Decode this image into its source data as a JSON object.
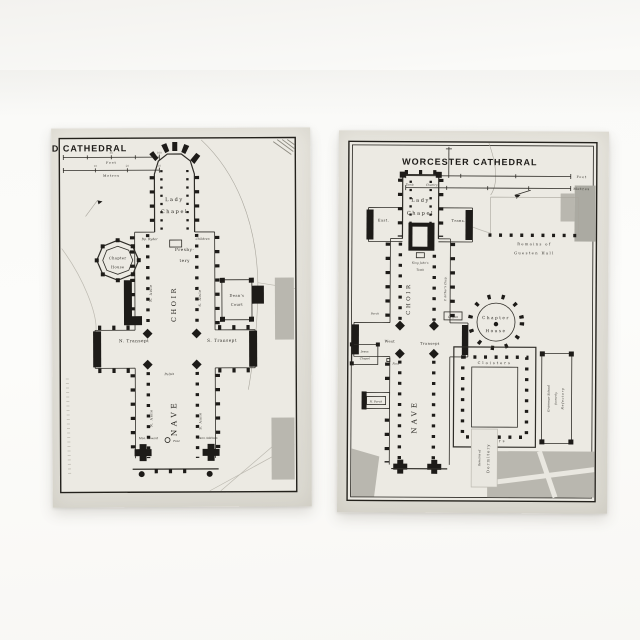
{
  "colors": {
    "background": "#fafaf8",
    "paper": "#e6e4dd",
    "ink": "#1d1b18",
    "shade": "#b9b7af"
  },
  "lichfield": {
    "title": "LICHFIELD CATHEDRAL",
    "scale": {
      "feet_label": "Feet",
      "metres_label": "Metres",
      "feet_ticks": [
        "50",
        "100"
      ],
      "metre_ticks": [
        "10",
        "20",
        "30"
      ]
    },
    "labels": {
      "lady1": "Lady",
      "lady2": "Chapel",
      "bp_ryder": "Bp. Ryder",
      "children": "Children",
      "chapter1": "Chapter",
      "chapter2": "House",
      "presbytery1": "Presby-",
      "presbytery2": "tery",
      "n_aisle_choir": "N. Aisle",
      "s_aisle_choir": "S. Aisle",
      "choir": "CHOIR",
      "deans1": "Dean's",
      "deans2": "Court",
      "n_transept": "N. Transept",
      "s_transept": "S. Transept",
      "pulpit": "Pulpit",
      "nave": "NAVE",
      "n_aisle_nave": "N. Aisle",
      "s_aisle_nave": "S. Aisle",
      "mon_seward": "Mon. Seward",
      "font": "Font",
      "dean_addison": "Dean Addison"
    }
  },
  "worcester": {
    "title": "WORCESTER CATHEDRAL",
    "scale": {
      "feet_label": "Feet",
      "metres_label": "Metres"
    },
    "labels": {
      "tomb": "Tomb",
      "chantry": "Chantry",
      "lady1": "Lady",
      "lady2": "Chapel",
      "east_l": "East.",
      "east_r": "Trans.",
      "king1": "King John's",
      "king2": "Tomb",
      "choir": "CHOIR",
      "p_arthur": "P. Arthur's Chap.",
      "organ": "Organ",
      "porch": "Porch",
      "west1": "West",
      "west2": "Transept",
      "chapter1": "Chapter",
      "chapter2": "House",
      "guesten1": "Remains of",
      "guesten2": "Guesten Hall",
      "cloisters_top": "Cloisters",
      "cloisters_bottom": "Cloisters",
      "jesus1": "Jesus",
      "jesus2": "Chapel",
      "font": "Font",
      "n_porch": "N. Porch",
      "nave": "NAVE",
      "dorm1": "Remains of",
      "dorm2": "Dormitory",
      "grammar1": "Grammar School",
      "grammar2": "formerly",
      "grammar3": "Refectory"
    }
  }
}
